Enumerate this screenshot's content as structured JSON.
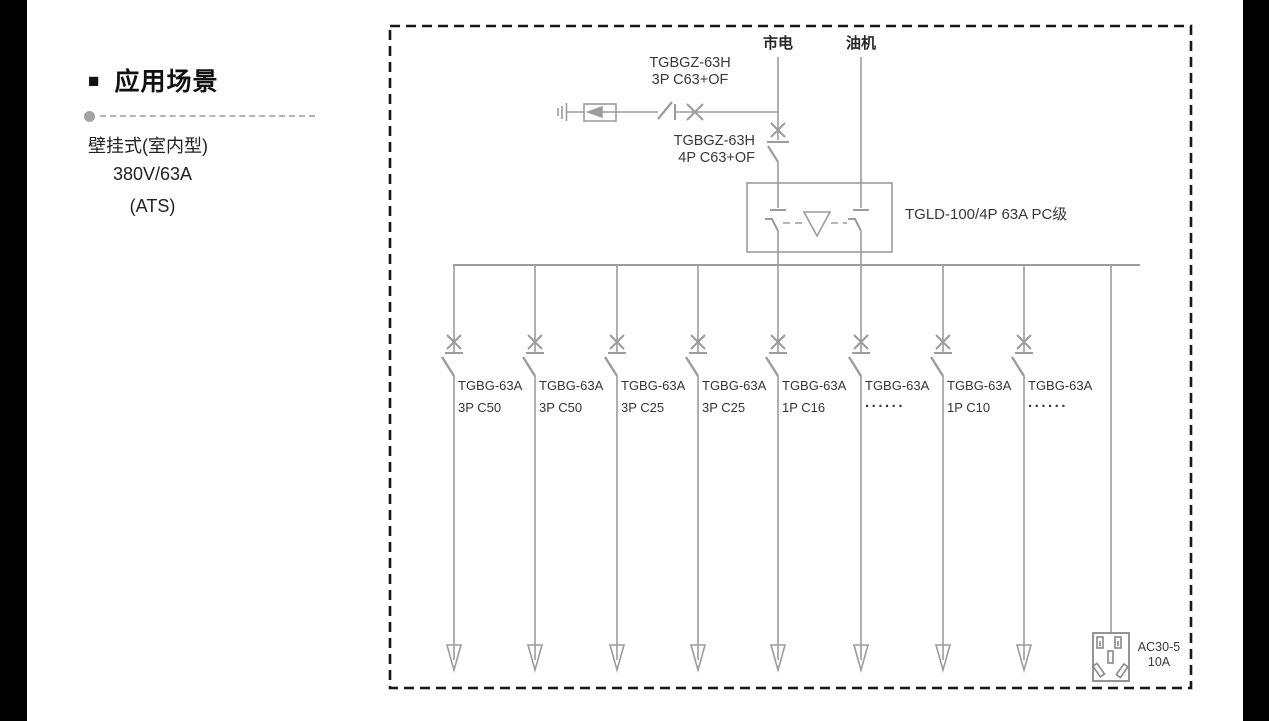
{
  "left_panel": {
    "bullet": "■",
    "heading": "应用场景",
    "subtitle_lines": [
      "壁挂式(室内型)",
      "380V/63A",
      "(ATS)"
    ]
  },
  "diagram": {
    "sources": {
      "mains": "市电",
      "generator": "油机"
    },
    "incoming_breaker_3p": {
      "line1": "TGBGZ-63H",
      "line2": "3P C63+OF"
    },
    "incoming_breaker_4p": {
      "line1": "TGBGZ-63H",
      "line2": "4P C63+OF"
    },
    "ats_label": "TGLD-100/4P 63A PC级",
    "branches": [
      {
        "model": "TGBG-63A",
        "spec": "3P C50"
      },
      {
        "model": "TGBG-63A",
        "spec": "3P C50"
      },
      {
        "model": "TGBG-63A",
        "spec": "3P C25"
      },
      {
        "model": "TGBG-63A",
        "spec": "3P C25"
      },
      {
        "model": "TGBG-63A",
        "spec": "1P C16"
      },
      {
        "model": "TGBG-63A",
        "spec": "......"
      },
      {
        "model": "TGBG-63A",
        "spec": "1P C10"
      },
      {
        "model": "TGBG-63A",
        "spec": "......"
      }
    ],
    "socket": {
      "model": "AC30-5",
      "rating": "10A"
    },
    "colors": {
      "wire": "#9c9c9c",
      "text": "#383838",
      "border": "#161616"
    }
  }
}
